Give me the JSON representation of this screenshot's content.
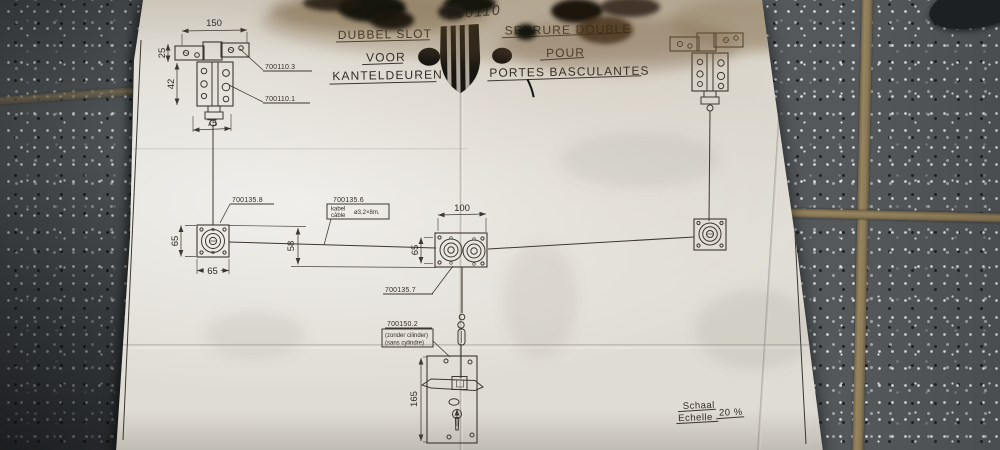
{
  "header": {
    "handwritten_ref": "700110",
    "nl": {
      "title": "DUBBEL SLOT",
      "line2": "VOOR",
      "line3": "KANTELDEUREN"
    },
    "fr": {
      "title": "SERRURE DOUBLE",
      "line2": "POUR",
      "line3": "PORTES BASCULANTES"
    }
  },
  "part_labels": {
    "bracket_arm": "700110.3",
    "bracket_body": "700110.1",
    "corner_pulley": "700135.8",
    "cable_ref": "700135.6",
    "cable_nl": "kabel",
    "cable_fr": "câble",
    "cable_spec": "ø3,2×8m.",
    "double_pulley": "700135.7",
    "lock_ref": "700150.2",
    "lock_note_nl": "(zonder cilinder)",
    "lock_note_fr": "(sans cylindre)"
  },
  "dimensions": {
    "bracket_width": "150",
    "bracket_bar_height": "25",
    "bracket_body_height": "42",
    "bracket_offset": "75",
    "corner_plate_h": "65",
    "corner_plate_w": "65",
    "cable_drop": "58",
    "pulley_spacing": "100",
    "pulley_plate_h": "65",
    "lock_plate_h": "165"
  },
  "scale": {
    "nl": "Schaal",
    "fr": "Echelle",
    "value": "20 %"
  },
  "colors": {
    "paper": "#dfdcd4",
    "ink": "#3c372f",
    "tile": "#54585b",
    "grout": "#8f7e59",
    "char": "#17130f"
  }
}
